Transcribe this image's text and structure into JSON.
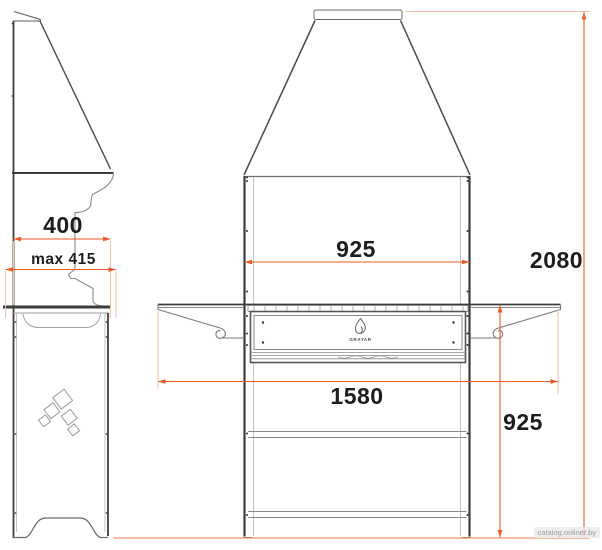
{
  "drawing": {
    "brand_logo_text": "GRATAR",
    "dimensions": {
      "depth": "400",
      "depth_max": "max 415",
      "firebox_width": "925",
      "overall_width": "1580",
      "worktop_height": "925",
      "overall_height": "2080"
    },
    "icons": {
      "front_logo": "flame-icon",
      "side_logo": "diamond-leaves-logo"
    },
    "colors": {
      "dimension_line": "#ee5a26",
      "extension_line": "#f6c0aa",
      "baseline": "#f2926b",
      "outline_dark": "#3d3d3d",
      "outline_light": "#9a9a9a",
      "label_text": "#1d1d1d"
    }
  },
  "watermark": {
    "text": "catalog.onliner.by"
  }
}
